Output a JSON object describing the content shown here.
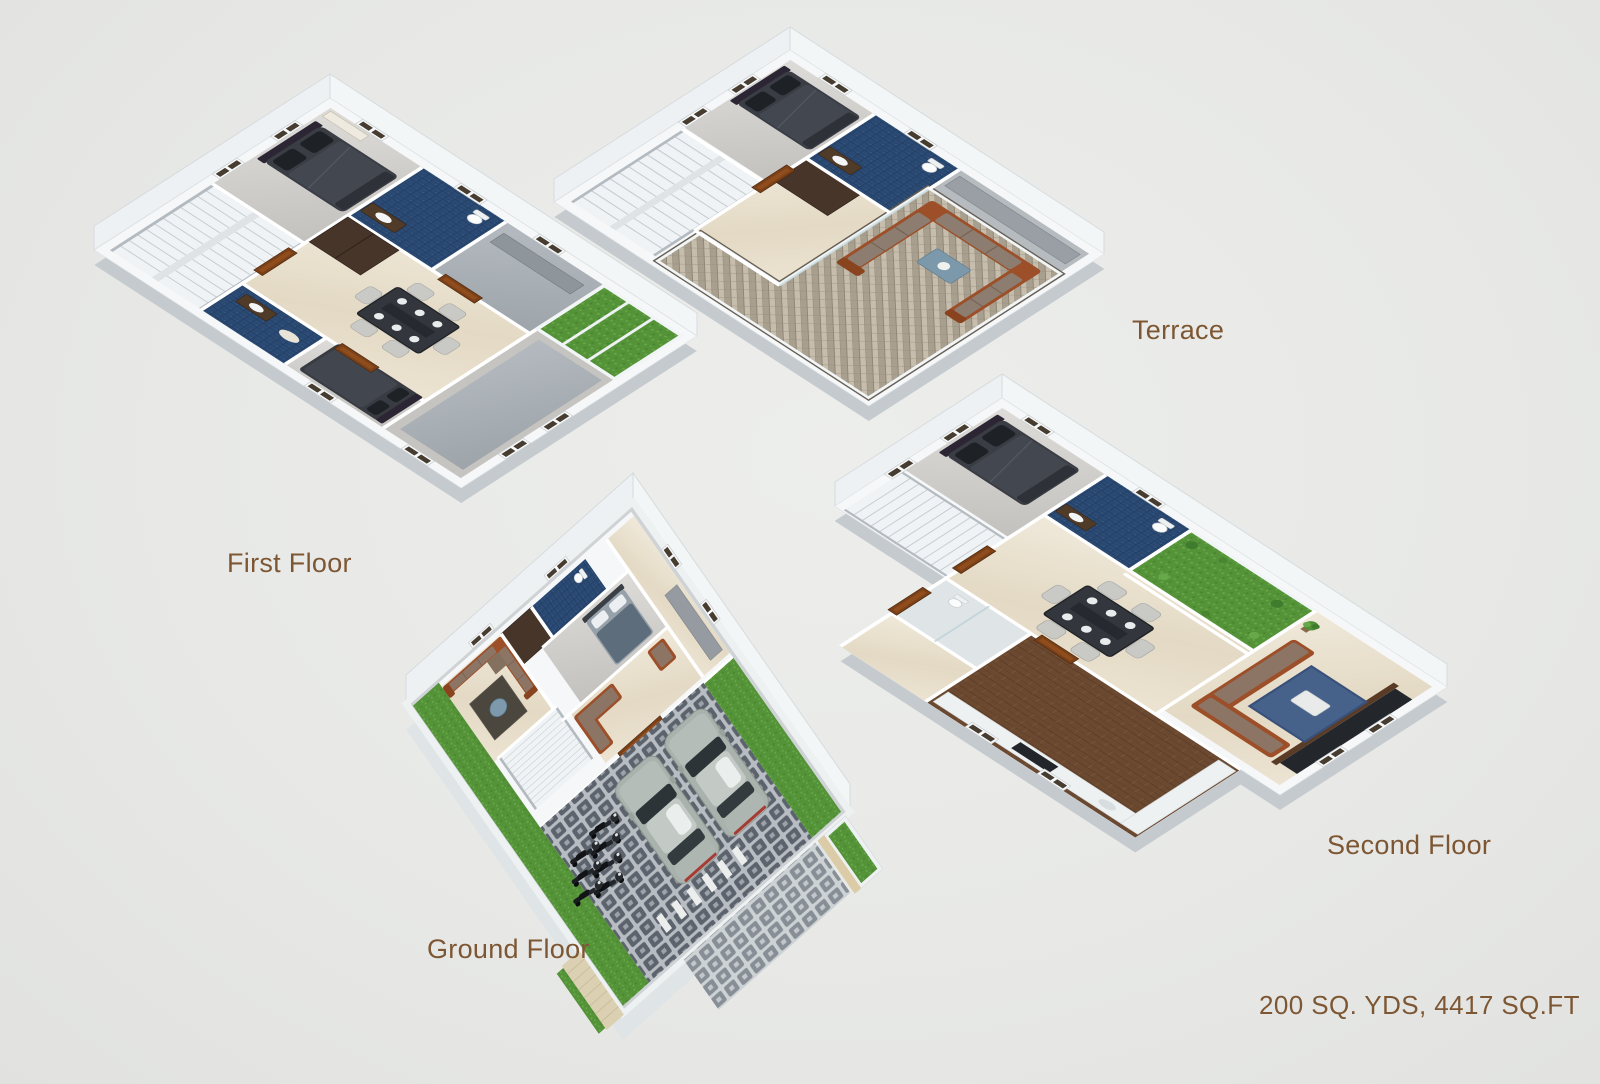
{
  "page": {
    "background_color": "#e8e9e7",
    "width": 1600,
    "height": 1084
  },
  "floors": [
    {
      "id": "first-floor",
      "label": "First Floor"
    },
    {
      "id": "terrace",
      "label": "Terrace"
    },
    {
      "id": "ground-floor",
      "label": "Ground Floor"
    },
    {
      "id": "second-floor",
      "label": "Second Floor"
    }
  ],
  "area_label": "200 SQ. YDS, 4417 SQ.FT",
  "colors": {
    "label_text": "#7d5733",
    "wall_white": "#f5f7f8",
    "marble_cream": "#e6dcc8",
    "marble_gray": "#d2d0cc",
    "bathroom_tile_blue": "#2b4a74",
    "lawn_green": "#559339",
    "sofa_rust": "#9c4f28",
    "sofa_cushion_taupe": "#8d7566",
    "bed_dark_gray": "#3a3d44",
    "terrace_paver_tan": "#c6bdac",
    "parking_paver_gray": "#5c636c",
    "wood_floor_brown": "#6b4930",
    "door_brown": "#7c4017",
    "car_body_gray": "#a9b2ad"
  }
}
